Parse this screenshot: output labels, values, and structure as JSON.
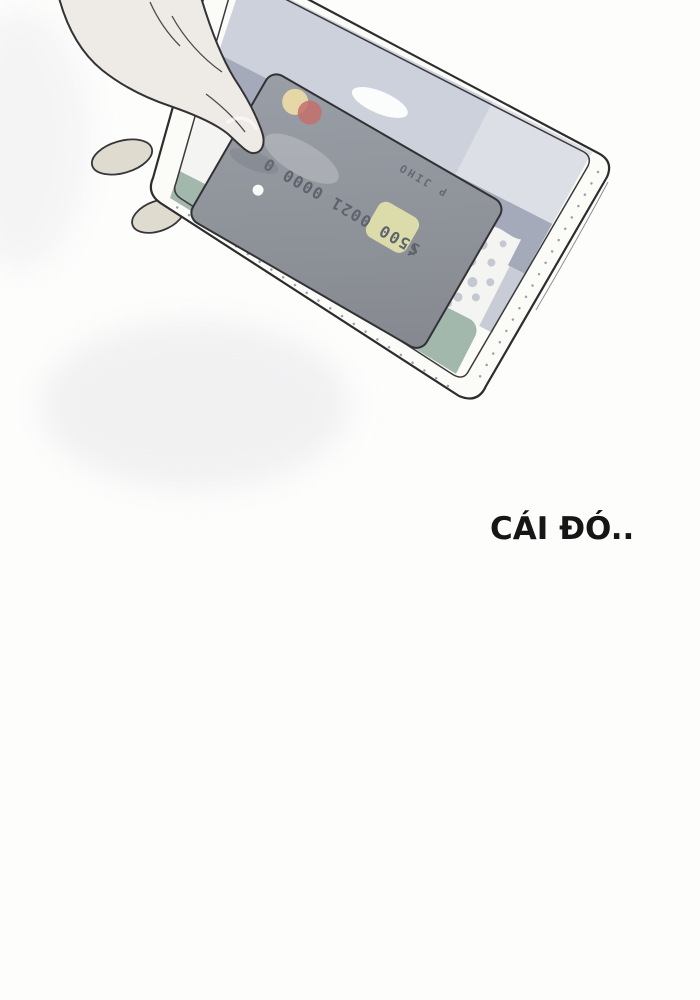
{
  "panel": {
    "dialogue_text": "CÁI ĐÓ..",
    "card": {
      "embossed_number": "5500 0021 0000 0",
      "embossed_name": "P JIHO"
    }
  },
  "palette": {
    "background": "#fdfdfc",
    "ink_outline": "#2d2d2f",
    "skin": "#eeebe6",
    "skin_shaded": "#dfdbcf",
    "sleeve_white": "#fbfbf8",
    "band_light_gray": "#cdd1db",
    "band_slate_gray": "#a4aab9",
    "band_dotted_white": "#f4f4f2",
    "band_right_light": "#c7ccd6",
    "dot_gray": "#c4c8d1",
    "band_sage_green": "#a2b8ad",
    "card_gray": "#8f939b",
    "chip_yellow": "#dcdcaa",
    "logo_cream": "#e6d8a6",
    "logo_red": "#c3706c",
    "card_text_gray": "#5f636d",
    "dialogue_ink": "#161616"
  }
}
